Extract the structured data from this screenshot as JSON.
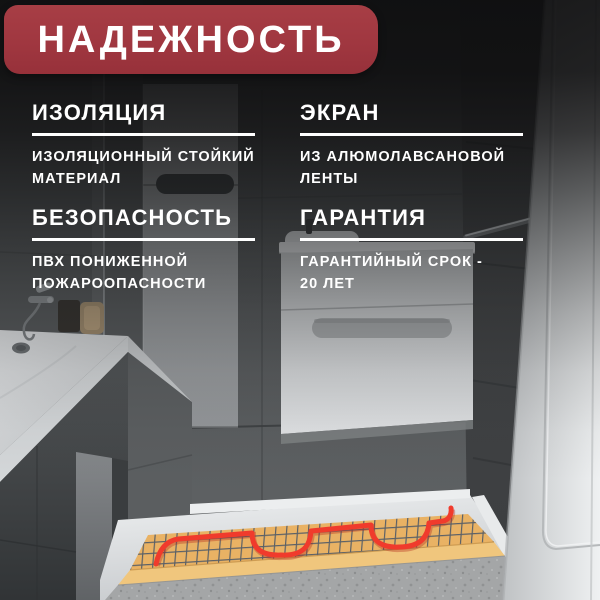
{
  "banner": {
    "title": "НАДЕЖНОСТЬ",
    "background": "#A03740",
    "text_color": "#FFFFFF"
  },
  "features": [
    {
      "id": "insulation",
      "heading": "ИЗОЛЯЦИЯ",
      "lines": [
        "ИЗОЛЯЦИОННЫЙ СТОЙКИЙ",
        "МАТЕРИАЛ"
      ]
    },
    {
      "id": "screen",
      "heading": "ЭКРАН",
      "lines": [
        "ИЗ АЛЮМОЛАВСАНОВОЙ",
        "ЛЕНТЫ"
      ]
    },
    {
      "id": "safety",
      "heading": "БЕЗОПАСНОСТЬ",
      "lines": [
        "ПВХ ПОНИЖЕННОЙ",
        "ПОЖАРООПАСНОСТИ"
      ]
    },
    {
      "id": "warranty",
      "heading": "ГАРАНТИЯ",
      "lines": [
        "ГАРАНТИЙНЫЙ СРОК -",
        "20 ЛЕТ"
      ]
    }
  ],
  "scene": {
    "name": "bathroom-with-underfloor-heating-mat",
    "colors": {
      "banner_red": "#A03740",
      "wall_tile": "#54575A",
      "dark_tile": "#454749",
      "fixture_white": "#E3E5E7",
      "floor": "#D6D8DA",
      "mat_surface": "#E9B264",
      "mat_border": "#F0C67D",
      "mesh_line": "#5A6067",
      "heating_cable": "#F03B2C",
      "concrete": "#A4A6A7"
    }
  }
}
